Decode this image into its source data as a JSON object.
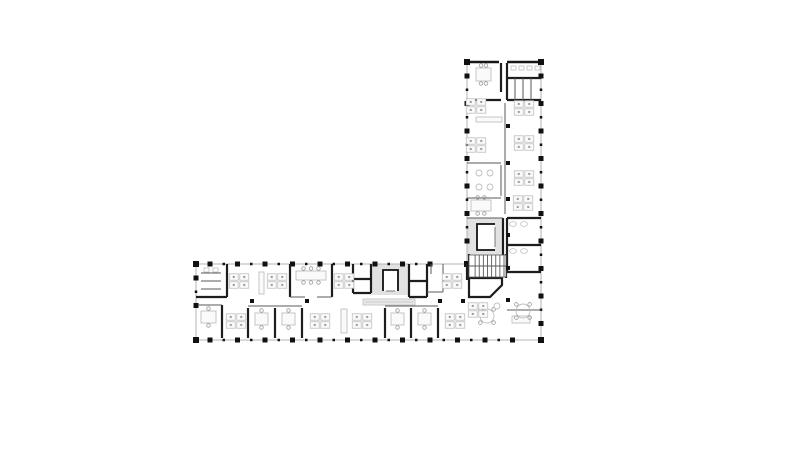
{
  "canvas": {
    "width": 800,
    "height": 472,
    "background": "#ffffff"
  },
  "colors": {
    "window_line": "#b3b3b3",
    "solid_wall": "#161616",
    "medium_wall": "#1d1d1d",
    "thin_wall": "#5a5a5a",
    "column": "#111111",
    "core_fill": "#e2e2e2",
    "furniture": "#bfbfbf",
    "furniture_dark": "#9a9a9a",
    "furniture_fill": "#fafafa",
    "counter_fill": "#e9e9e9"
  },
  "plan": {
    "exterior_walls": [
      {
        "name": "vwing-left",
        "axis": "v",
        "pos": 467,
        "from": 62,
        "to": 264
      },
      {
        "name": "vwing-top",
        "axis": "h",
        "pos": 62,
        "from": 467,
        "to": 541,
        "solid": true,
        "gap": [
          499,
          507
        ]
      },
      {
        "name": "right",
        "axis": "v",
        "pos": 541,
        "from": 62,
        "to": 340
      },
      {
        "name": "hwing-top",
        "axis": "h",
        "pos": 264,
        "from": 196,
        "to": 467
      },
      {
        "name": "hwing-left",
        "axis": "v",
        "pos": 196,
        "from": 264,
        "to": 340
      },
      {
        "name": "bottom",
        "axis": "h",
        "pos": 340,
        "from": 196,
        "to": 541
      }
    ],
    "column_spacing": 27.5,
    "column_size": 5,
    "column_inset": 14,
    "interior_columns": [
      [
        508,
        126
      ],
      [
        508,
        163
      ],
      [
        508,
        199
      ],
      [
        508,
        235
      ],
      [
        508,
        268
      ],
      [
        508,
        300
      ],
      [
        252,
        301
      ],
      [
        307,
        301
      ],
      [
        440,
        301
      ],
      [
        463,
        301
      ]
    ],
    "medium_walls": [
      [
        507,
        63,
        507,
        100
      ],
      [
        507,
        78,
        541,
        78
      ],
      [
        507,
        100,
        541,
        100
      ],
      [
        501,
        63,
        501,
        92
      ],
      [
        467,
        100,
        501,
        100
      ],
      [
        507,
        218,
        507,
        272
      ],
      [
        507,
        218,
        541,
        218
      ],
      [
        507,
        245,
        541,
        245
      ],
      [
        507,
        272,
        541,
        272
      ],
      [
        503,
        218,
        503,
        256
      ],
      [
        469,
        254,
        469,
        278
      ],
      [
        506,
        254,
        506,
        278
      ],
      [
        467,
        264,
        467,
        280
      ],
      [
        227,
        264,
        227,
        297
      ],
      [
        196,
        297,
        227,
        297
      ],
      [
        222,
        305,
        222,
        338
      ],
      [
        290,
        264,
        290,
        297
      ],
      [
        332,
        264,
        332,
        297
      ],
      [
        353,
        264,
        353,
        293
      ],
      [
        371,
        264,
        371,
        293
      ],
      [
        353,
        293,
        371,
        293
      ],
      [
        353,
        279,
        371,
        279
      ],
      [
        409,
        264,
        409,
        297
      ],
      [
        427,
        264,
        427,
        297
      ],
      [
        409,
        297,
        427,
        297
      ],
      [
        409,
        281,
        427,
        281
      ],
      [
        248,
        308,
        248,
        338
      ],
      [
        275,
        308,
        275,
        338
      ],
      [
        302,
        308,
        302,
        338
      ],
      [
        385,
        308,
        385,
        338
      ],
      [
        411,
        308,
        411,
        338
      ],
      [
        438,
        308,
        438,
        338
      ]
    ],
    "thin_walls": [
      [
        467,
        163,
        501,
        163
      ],
      [
        467,
        198,
        501,
        198
      ],
      [
        467,
        218,
        503,
        218
      ],
      [
        501,
        165,
        501,
        196
      ],
      [
        505,
        103,
        505,
        214
      ],
      [
        515,
        78,
        515,
        100
      ],
      [
        523,
        78,
        523,
        100
      ],
      [
        531,
        78,
        531,
        100
      ],
      [
        201,
        273,
        221,
        273
      ],
      [
        201,
        281,
        221,
        281
      ],
      [
        201,
        289,
        221,
        289
      ],
      [
        198,
        305,
        222,
        305
      ],
      [
        290,
        297,
        305,
        297
      ],
      [
        317,
        297,
        332,
        297
      ],
      [
        431,
        264,
        431,
        274
      ],
      [
        443,
        264,
        443,
        292
      ],
      [
        427,
        292,
        443,
        292
      ],
      [
        248,
        306,
        302,
        306
      ],
      [
        385,
        306,
        438,
        306
      ],
      [
        507,
        310,
        541,
        310
      ]
    ],
    "diagonal_room_path": "M469,278 L502,278 L502,285 L490,297 L469,297 Z",
    "cores": [
      {
        "x": 467,
        "y": 218,
        "w": 36,
        "h": 38
      },
      {
        "x": 371,
        "y": 264,
        "w": 38,
        "h": 31
      }
    ],
    "elevators": [
      {
        "x": 477,
        "y": 224,
        "w": 18,
        "h": 26,
        "open": "right"
      },
      {
        "x": 383,
        "y": 270,
        "w": 15,
        "h": 21,
        "open": "bottom"
      }
    ],
    "stairs": [
      {
        "x": 469,
        "y": 255,
        "w": 37,
        "h": 22,
        "treads": 8
      }
    ],
    "furniture": [
      {
        "t": "table",
        "x": 476,
        "y": 68,
        "w": 15,
        "h": 13,
        "chairs": 4
      },
      {
        "t": "fixture",
        "x": 511,
        "y": 66
      },
      {
        "t": "fixture",
        "x": 519,
        "y": 66
      },
      {
        "t": "fixture",
        "x": 527,
        "y": 66
      },
      {
        "t": "fixture",
        "x": 535,
        "y": 66
      },
      {
        "t": "cluster",
        "x": 476,
        "y": 106
      },
      {
        "t": "cluster",
        "x": 476,
        "y": 145
      },
      {
        "t": "desk",
        "x": 476,
        "y": 117,
        "w": 26,
        "h": 5
      },
      {
        "t": "round-sm",
        "x": 479,
        "y": 173
      },
      {
        "t": "round-sm",
        "x": 490,
        "y": 173
      },
      {
        "t": "round-sm",
        "x": 479,
        "y": 187
      },
      {
        "t": "round-sm",
        "x": 490,
        "y": 187
      },
      {
        "t": "table",
        "x": 471,
        "y": 200,
        "w": 20,
        "h": 11,
        "chairs": 4
      },
      {
        "t": "cluster",
        "x": 524,
        "y": 108
      },
      {
        "t": "cluster",
        "x": 524,
        "y": 143
      },
      {
        "t": "cluster",
        "x": 524,
        "y": 178
      },
      {
        "t": "cluster",
        "x": 523,
        "y": 203
      },
      {
        "t": "sink",
        "x": 513,
        "y": 224
      },
      {
        "t": "sink",
        "x": 524,
        "y": 224
      },
      {
        "t": "sink",
        "x": 513,
        "y": 251
      },
      {
        "t": "sink",
        "x": 524,
        "y": 251
      },
      {
        "t": "desk",
        "x": 512,
        "y": 316,
        "w": 18,
        "h": 7
      },
      {
        "t": "round",
        "x": 487,
        "y": 316,
        "r": 7
      },
      {
        "t": "round",
        "x": 523,
        "y": 311,
        "r": 7
      },
      {
        "t": "cluster",
        "x": 478,
        "y": 310
      },
      {
        "t": "fixture",
        "x": 204,
        "y": 268
      },
      {
        "t": "fixture",
        "x": 213,
        "y": 268
      },
      {
        "t": "cluster",
        "x": 239,
        "y": 281
      },
      {
        "t": "desk",
        "x": 259,
        "y": 272,
        "w": 5,
        "h": 22
      },
      {
        "t": "cluster",
        "x": 277,
        "y": 281
      },
      {
        "t": "table-long",
        "x": 296,
        "y": 271,
        "w": 30,
        "h": 9
      },
      {
        "t": "cluster",
        "x": 344,
        "y": 281
      },
      {
        "t": "cluster",
        "x": 452,
        "y": 281
      },
      {
        "t": "counter",
        "x": 363,
        "y": 299,
        "w": 52,
        "h": 6
      },
      {
        "t": "table",
        "x": 201,
        "y": 311,
        "w": 15,
        "h": 12,
        "chairs": 2
      },
      {
        "t": "cluster",
        "x": 236,
        "y": 321
      },
      {
        "t": "table",
        "x": 255,
        "y": 313,
        "w": 13,
        "h": 12,
        "chairs": 2
      },
      {
        "t": "table",
        "x": 282,
        "y": 313,
        "w": 13,
        "h": 12,
        "chairs": 2
      },
      {
        "t": "cluster",
        "x": 320,
        "y": 321
      },
      {
        "t": "desk",
        "x": 341,
        "y": 309,
        "w": 6,
        "h": 24
      },
      {
        "t": "cluster",
        "x": 362,
        "y": 321
      },
      {
        "t": "table",
        "x": 391,
        "y": 313,
        "w": 13,
        "h": 12,
        "chairs": 2
      },
      {
        "t": "table",
        "x": 418,
        "y": 313,
        "w": 13,
        "h": 12,
        "chairs": 2
      },
      {
        "t": "cluster",
        "x": 455,
        "y": 321
      },
      {
        "t": "round-sm",
        "x": 497,
        "y": 306
      }
    ]
  }
}
